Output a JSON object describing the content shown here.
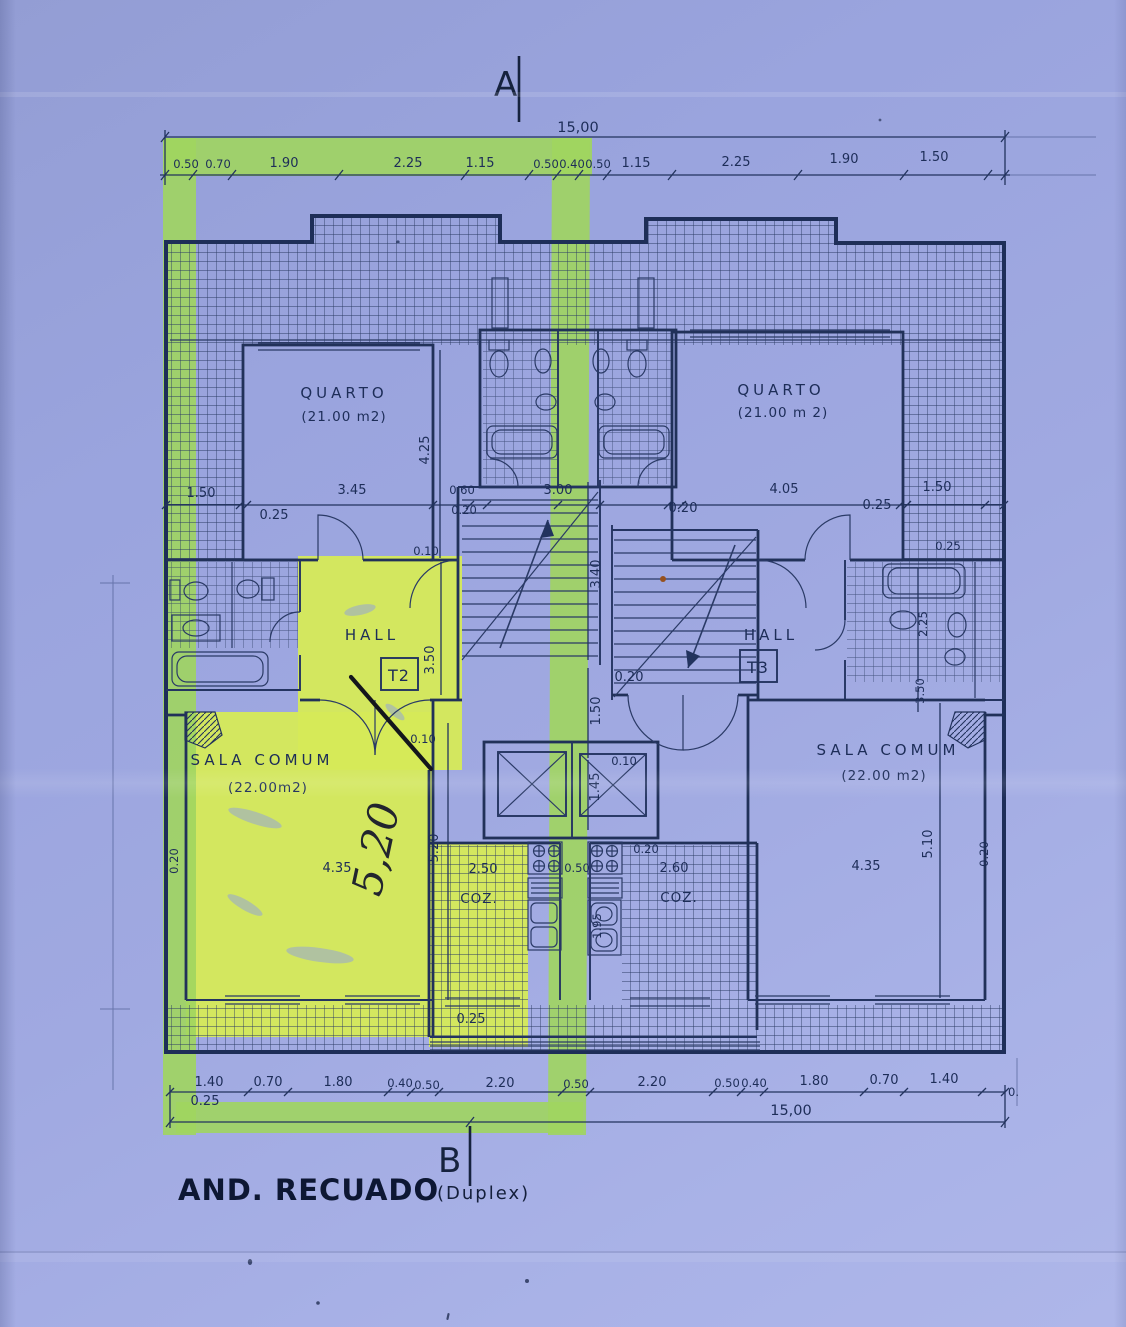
{
  "markers": {
    "top": "A",
    "bottom": "B"
  },
  "title": {
    "main": "AND. RECUADO",
    "sub": "(Duplex)"
  },
  "totals": {
    "top": "15,00",
    "bottom": "15,00",
    "bottom_right": "0."
  },
  "dims_top": [
    "0.50",
    "0.70",
    "1.90",
    "2.25",
    "1.15",
    "0.50",
    "0.40",
    "0.50",
    "1.15",
    "2.25",
    "1.90",
    "1.50"
  ],
  "dims_bottom": [
    "1.40",
    "0.70",
    "1.80",
    "0.40",
    "0.50",
    "2.20",
    "0.50",
    "2.20",
    "0.50",
    "0.40",
    "1.80",
    "0.70",
    "1.40"
  ],
  "dims_bottom_offset": "0.25",
  "dims_mid": {
    "balcony_left": "1.50",
    "wall_left": "0.25",
    "quarto_left_width": "3.45",
    "shaft": "0.60",
    "shaft_wall": "0.20",
    "stair_width": "3.00",
    "stair_wall": "0.20",
    "quarto_right_width": "4.05",
    "wall_right": "0.25",
    "balcony_right": "1.50",
    "balcony_right_depth": "0.25"
  },
  "dims_inner": {
    "door_left": "0.10",
    "quarto_left_depth": "4.25",
    "stair_depth": "3.40",
    "hall_left_depth": "3.50",
    "landing": "0.20",
    "core_width": "1.50",
    "core_gap": "0.10",
    "elevator": "1.45",
    "sala_door_left": "0.10",
    "bath_right_width": "2.25",
    "hall_right_depth": "3.50",
    "sala_left_wall": "0.20",
    "sala_left_width": "4.35",
    "sala_right_width": "4.35",
    "sala_right_depth": "5.10",
    "sala_right_wall": "0.20",
    "kitchen_left_depth": "5.20",
    "kitchen_left_width": "2.50",
    "kitchen_gap": "0.50",
    "kitchen_right_width": "2.60",
    "kitchen_right_wall": "0.20",
    "kitchen_sink": "1.95",
    "kitchen_bottom": "0.25"
  },
  "rooms": {
    "quarto_left": {
      "name": "QUARTO",
      "area": "(21.00 m2)"
    },
    "quarto_right": {
      "name": "QUARTO",
      "area": "(21.00 m 2)"
    },
    "hall_left": {
      "name": "HALL",
      "unit": "T2"
    },
    "hall_right": {
      "name": "HALL",
      "unit": "T3"
    },
    "sala_left": {
      "name": "SALA COMUM",
      "area": "(22.00m2)"
    },
    "sala_right": {
      "name": "SALA COMUM",
      "area": "(22.00 m2)"
    },
    "kitchen_left": {
      "name": "COZ."
    },
    "kitchen_right": {
      "name": "COZ."
    }
  },
  "handwriting": {
    "dim": "5,20"
  }
}
